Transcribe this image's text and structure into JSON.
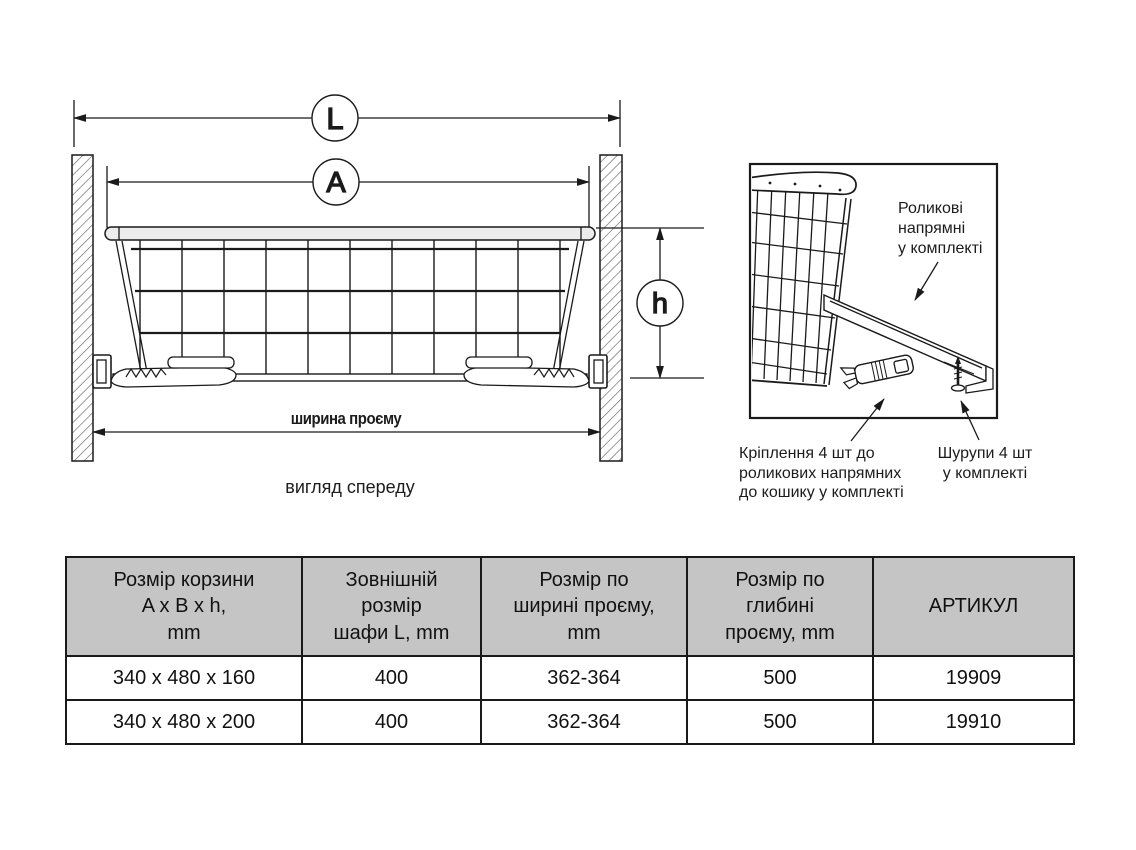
{
  "colors": {
    "line": "#1a1a1a",
    "table_header_bg": "#c5c5c5",
    "background": "#ffffff"
  },
  "front_view": {
    "dim_outer": "L",
    "dim_inner": "A",
    "dim_height": "h",
    "opening_width_label": "ширина проєму",
    "caption": "вигляд спереду"
  },
  "detail_view": {
    "rail_label": "Роликові\nнапрямні\nу комплекті",
    "clip_label": "Кріплення 4 шт до\nроликових напрямних\nдо кошику у комплекті",
    "screw_label": "Шурупи 4 шт\nу комплекті"
  },
  "table": {
    "headers": [
      "Розмір корзини\nA x B x h,\nmm",
      "Зовнішній\nрозмір\nшафи L, mm",
      "Розмір по\nширині проєму,\nmm",
      "Розмір по\nглибині\nпроєму, mm",
      "АРТИКУЛ"
    ],
    "rows": [
      [
        "340 x 480 x 160",
        "400",
        "362-364",
        "500",
        "19909"
      ],
      [
        "340 x 480 x 200",
        "400",
        "362-364",
        "500",
        "19910"
      ]
    ]
  }
}
